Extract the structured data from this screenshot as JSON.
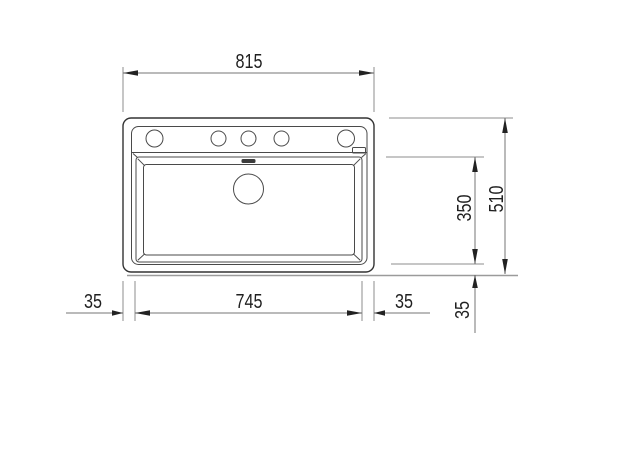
{
  "drawing": {
    "kind": "sink-top-view-dimension-drawing",
    "dims": {
      "overall_width": "815",
      "overall_depth": "510",
      "bowl_depth": "350",
      "bowl_width": "745",
      "offset_left": "35",
      "offset_right": "35",
      "offset_bottom": "35"
    },
    "colors": {
      "background": "#ffffff",
      "outline": "#333333",
      "detail_line": "#4a4a4a",
      "dimension_line": "#757575",
      "extension_line": "#8c8c8c",
      "arrow": "#222222",
      "label_text": "#1f1f1f",
      "shadow": "#9b9b9b",
      "overflow_fill": "#3c3c3c"
    }
  }
}
